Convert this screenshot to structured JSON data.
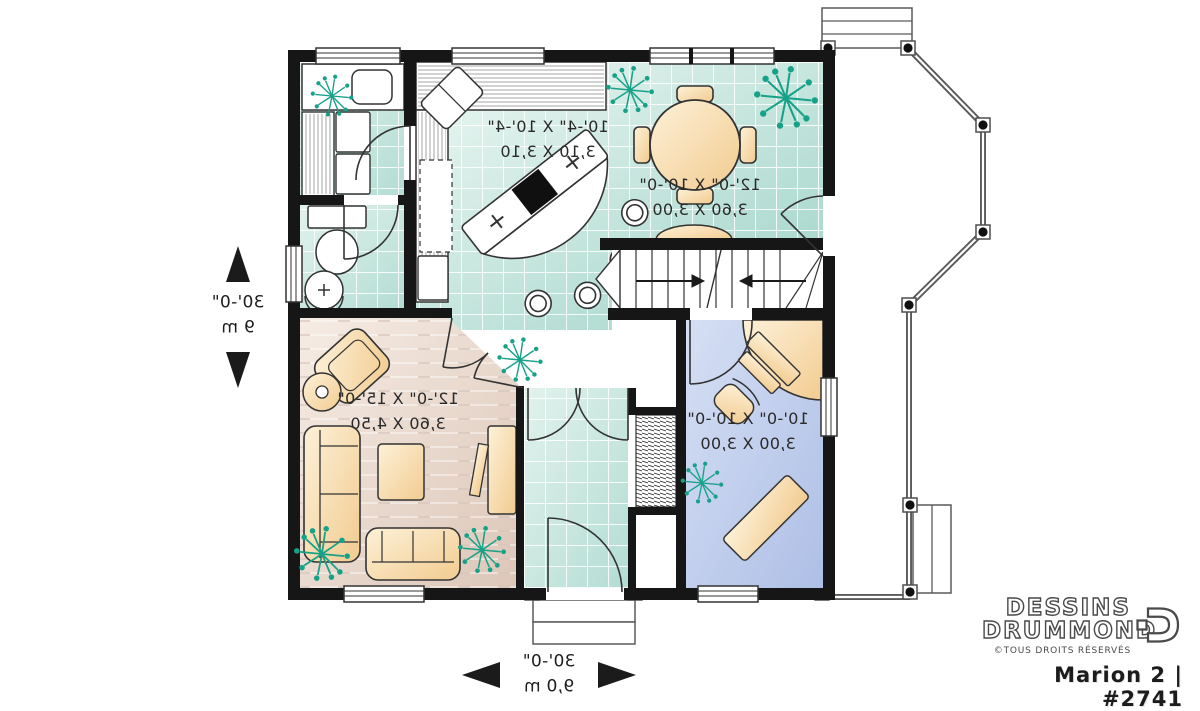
{
  "rooms": {
    "kitchen": {
      "imperial": "10'-4\" X 10'-4\"",
      "metric": "3,10 X 3,10"
    },
    "dining": {
      "imperial": "12'-0\" X 10'-0\"",
      "metric": "3,60 X 3,00"
    },
    "living": {
      "imperial": "12'-0\" X 15'-0\"",
      "metric": "3,60 X 4,50"
    },
    "office": {
      "imperial": "10'-0\" X 10'-0\"",
      "metric": "3,00 X 3,00"
    }
  },
  "dimensions": {
    "left": {
      "feet": "30'-0\"",
      "meters": "9 m"
    },
    "bottom": {
      "feet": "30'-0\"",
      "meters": "9,0 m"
    }
  },
  "branding": {
    "name_line1": "DESSINS",
    "name_line2": "DRUMMOND",
    "rights": "©TOUS DROITS RÉSERVÉS",
    "plan_title": "Marion 2  |  #2741"
  },
  "colors": {
    "wall": "#161616",
    "tile_floor": "#cde8e1",
    "wood_floor": "#e9d8cb",
    "office_floor": "#c0d0ec",
    "furniture": "#f8d9a4",
    "plant": "#17a189",
    "porch_line": "#5a5a5a"
  }
}
